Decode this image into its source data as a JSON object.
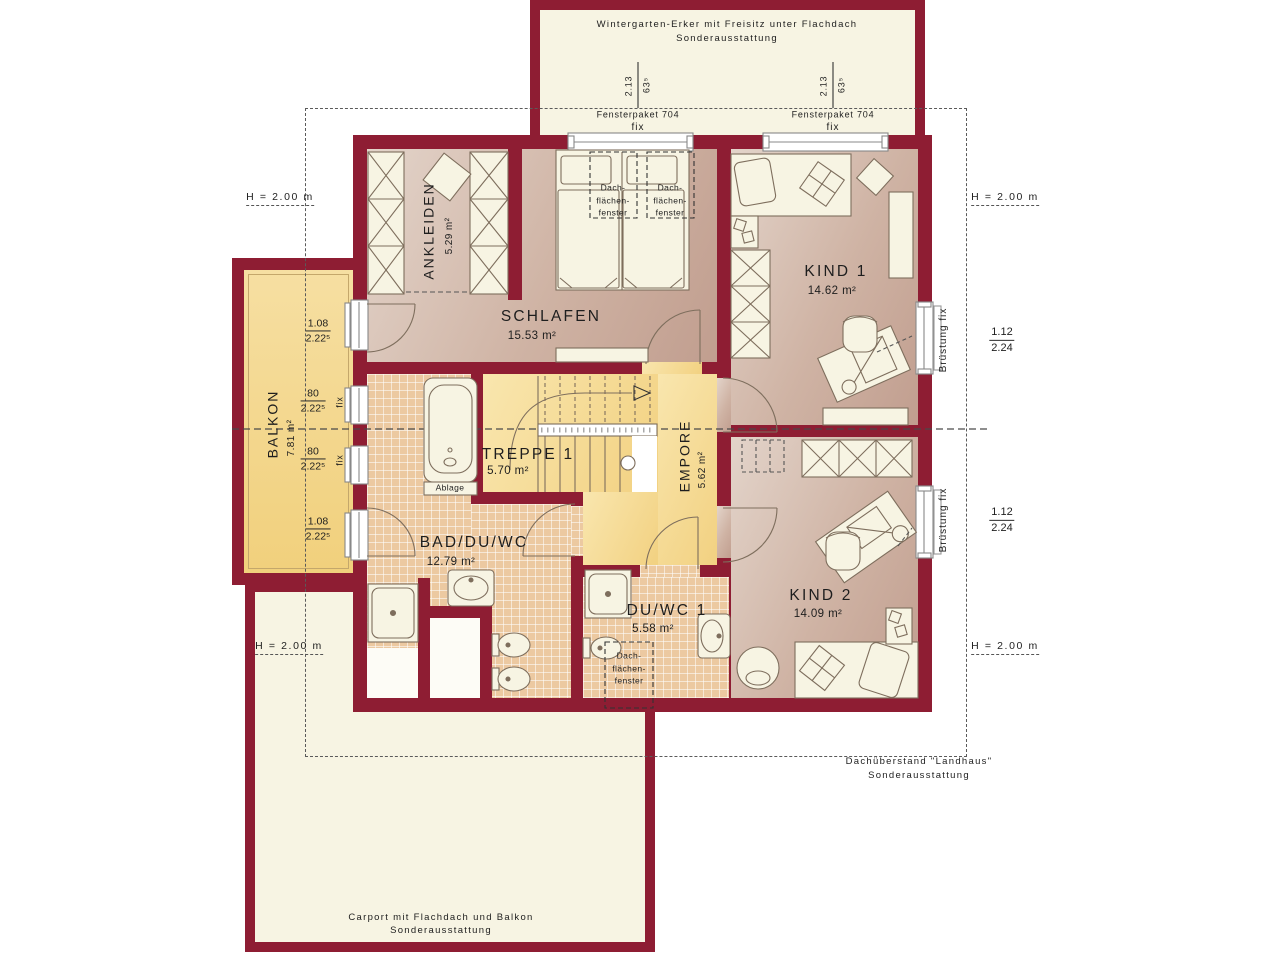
{
  "plan": {
    "wintergarten": {
      "line1": "Wintergarten-Erker mit Freisitz unter Flachdach",
      "line2": "Sonderausstattung"
    },
    "carport": {
      "line1": "Carport mit Flachdach und Balkon",
      "line2": "Sonderausstattung"
    },
    "dachueberstand": {
      "line1": "Dachüberstand \"Landhaus\"",
      "line2": "Sonderausstattung"
    },
    "height_marker": "H = 2.00 m",
    "rooms": {
      "ankleiden": {
        "name": "ANKLEIDEN",
        "area": "5.29 m²"
      },
      "schlafen": {
        "name": "SCHLAFEN",
        "area": "15.53 m²"
      },
      "kind1": {
        "name": "KIND 1",
        "area": "14.62 m²"
      },
      "kind2": {
        "name": "KIND 2",
        "area": "14.09 m²"
      },
      "balkon": {
        "name": "BALKON",
        "area": "7.81 m²"
      },
      "treppe": {
        "name": "TREPPE 1",
        "area": "5.70 m²"
      },
      "empore": {
        "name": "EMPORE",
        "area": "5.62 m²"
      },
      "bad": {
        "name": "BAD/DU/WC",
        "area": "12.79 m²"
      },
      "duwc": {
        "name": "DU/WC 1",
        "area": "5.58 m²"
      }
    },
    "windows": {
      "fensterpaket": "Fensterpaket 704",
      "fix": "fix",
      "bruestung_fix": "Brüstung fix",
      "roof_height": "2.13",
      "roof_width": "63⁵",
      "w108": "1.08",
      "w80": "80",
      "h2225": "2.22⁵",
      "w112": "1.12",
      "h224": "2.24"
    },
    "fixtures": {
      "ablage": "Ablage",
      "roof_window": {
        "l1": "Dach-",
        "l2": "flächen-",
        "l3": "fenster"
      }
    },
    "colors": {
      "wall": "#8e1d33",
      "cream": "#f7f4e3",
      "floor_warm": "#cfb3a4",
      "floor_yellow": "#f2d181",
      "floor_tile": "#ecc9a1"
    }
  }
}
